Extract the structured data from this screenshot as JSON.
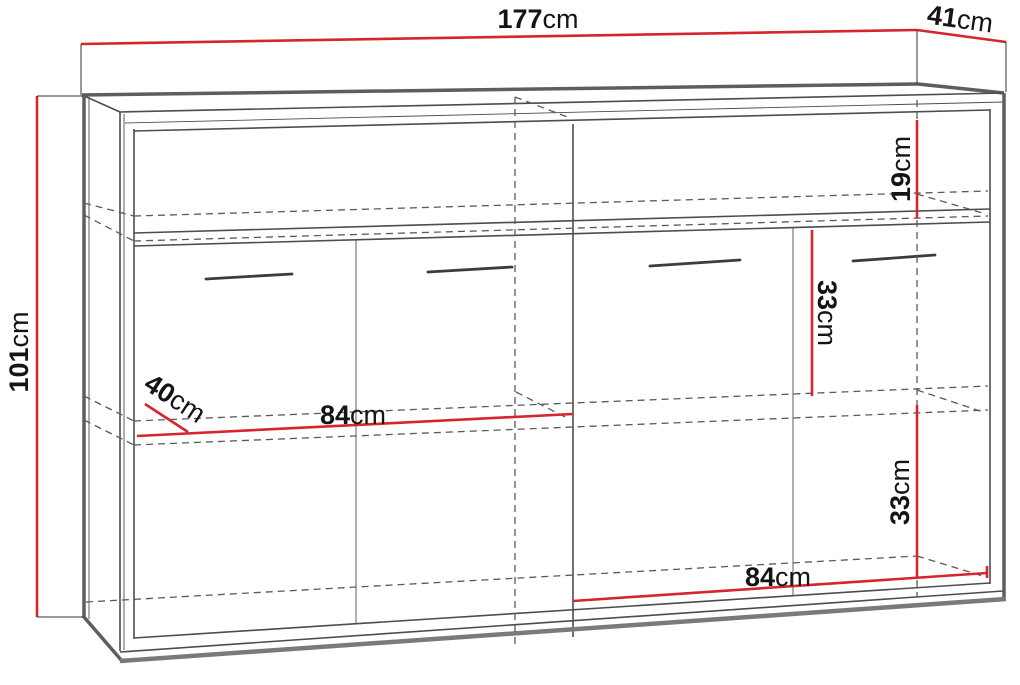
{
  "diagram": {
    "unit": "cm",
    "dimensions": {
      "width": {
        "value": "177",
        "unit": "cm",
        "label": "177cm"
      },
      "depth": {
        "value": "41",
        "unit": "cm",
        "label": "41cm"
      },
      "height": {
        "value": "101",
        "unit": "cm",
        "label": "101cm"
      },
      "top_niche_height": {
        "value": "19",
        "unit": "cm",
        "label": "19cm"
      },
      "upper_section_height": {
        "value": "33",
        "unit": "cm",
        "label": "33cm"
      },
      "lower_section_height": {
        "value": "33",
        "unit": "cm",
        "label": "33cm"
      },
      "left_inner_width": {
        "value": "84",
        "unit": "cm",
        "label": "84cm"
      },
      "shelf_depth": {
        "value": "40",
        "unit": "cm",
        "label": "40cm"
      },
      "right_inner_width": {
        "value": "84",
        "unit": "cm",
        "label": "84cm"
      }
    },
    "colors": {
      "dimension_line": "#d4262c",
      "outline": "#4d4d4d",
      "text": "#141414",
      "background": "#ffffff"
    }
  }
}
